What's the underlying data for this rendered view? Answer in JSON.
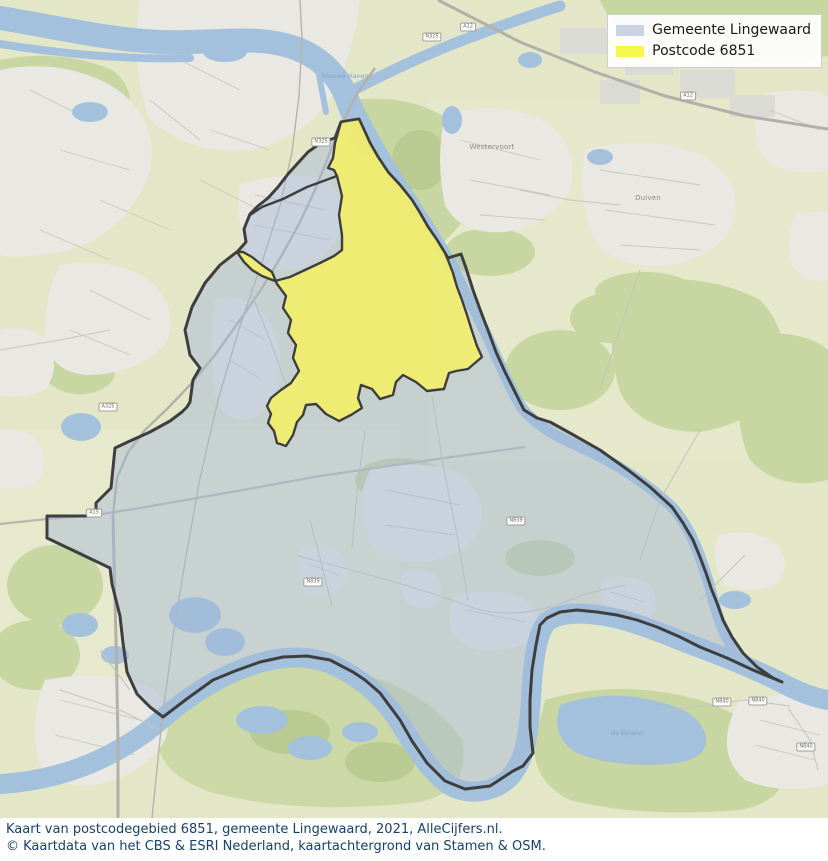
{
  "legend": {
    "items": [
      {
        "label": "Gemeente Lingewaard",
        "color": "#c9d3e1"
      },
      {
        "label": "Postcode 6851",
        "color": "#f6f64d"
      }
    ]
  },
  "caption": {
    "line1": "Kaart van postcodegebied 6851, gemeente Lingewaard, 2021, AlleCijfers.nl.",
    "line2": "© Kaartdata van het CBS & ESRI Nederland, kaartachtergrond van Stamen & OSM.",
    "text_color": "#17406e"
  },
  "map": {
    "region_fills": {
      "municipality_fill": "#aebfd6",
      "postcode_fill": "#f2ee6c",
      "boundary_color": "#3e3e3e",
      "water_color": "#a3c1dd",
      "land_color": "#e4e6c8"
    },
    "town_labels": [
      {
        "name": "Westervoort"
      },
      {
        "name": "Duiven"
      }
    ],
    "water_labels": [
      {
        "name": "Nieuwe Haven"
      },
      {
        "name": "de Bijland"
      }
    ],
    "road_shields": [
      {
        "label": "A12"
      },
      {
        "label": "A12"
      },
      {
        "label": "N325"
      },
      {
        "label": "N325"
      },
      {
        "label": "A325"
      },
      {
        "label": "A15"
      },
      {
        "label": "N839"
      },
      {
        "label": "N839"
      },
      {
        "label": "N840"
      },
      {
        "label": "N840"
      },
      {
        "label": "N840"
      }
    ]
  }
}
